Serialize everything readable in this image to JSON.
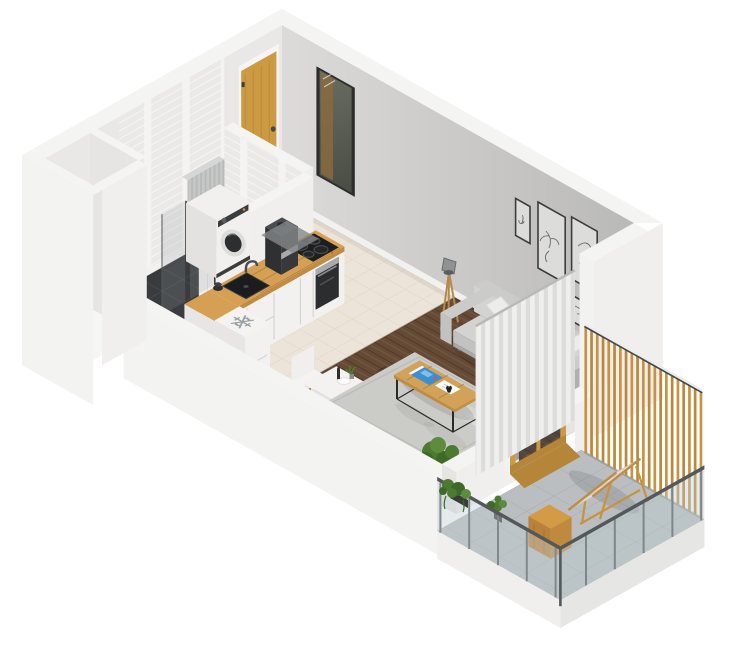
{
  "scene": {
    "type": "isometric-floorplan-render",
    "description": "3D isometric cutaway render of a studio apartment: bathroom with washing machine, entry hall with wooden door and mirror, L-shaped kitchen with cooktop, oven, coffee machine, sink and under-counter fridge, living-dining area with sofa, rug, coffee table, dining table, floor lamp and wall art, and a balcony with glass railing, wooden slat screen, lounger and plants.",
    "width_px": 750,
    "height_px": 668
  },
  "icons": {
    "snowflake": {
      "name": "snowflake-icon",
      "glyph": "❄"
    }
  },
  "rooms": [
    {
      "id": "bathroom",
      "label": "Bathroom"
    },
    {
      "id": "entry",
      "label": "Entry hall"
    },
    {
      "id": "kitchen",
      "label": "Kitchen"
    },
    {
      "id": "living-dining",
      "label": "Living / dining room"
    },
    {
      "id": "balcony",
      "label": "Balcony"
    }
  ],
  "objects": [
    "entry-door",
    "wall-mirror",
    "washing-machine",
    "shower-glass",
    "kitchen-counter",
    "cooktop",
    "oven",
    "coffee-machine",
    "kitchen-sink",
    "under-counter-fridge",
    "dining-table",
    "dining-chairs",
    "floor-plant",
    "sofa",
    "throw-pillows",
    "area-rug",
    "coffee-table",
    "magazine",
    "floor-lamp",
    "picture-frames",
    "curtains",
    "balcony-door",
    "balcony-lounger",
    "balcony-crate",
    "glass-railing",
    "wood-slat-screen",
    "hanging-plant"
  ],
  "colors": {
    "bg": "#ffffff",
    "wall_top": "#f4f4f2",
    "wall_white": "#f0efed",
    "wall_ext": "#f3f3f1",
    "wall_face": "#e9e8e6",
    "wall_inner": "#e6e5e3",
    "baseboard": "#f1f1ef",
    "wall_gray_light": "#dcdbd9",
    "wall_gray": "#cecdcb",
    "wall_gray_dark": "#b7b7b5",
    "brick": "#eae9e7",
    "brick_line": "#f7f6f4",
    "bath_tile": "#393b3e",
    "bath_grout": "#4d4f52",
    "tile": "#ece4d8",
    "tile_grout": "#dcd3c6",
    "wood": "#654b36",
    "wood_line": "#50392a",
    "counter_wood": "#d6a054",
    "counter_edge": "#c08c43",
    "cabinet": "#f2f1ef",
    "cabinet_shade": "#e7e6e4",
    "seam": "#d8d5d1",
    "appliance_dark": "#2c2d2f",
    "appliance_panel": "#1d1e20",
    "steel": "#a8aaac",
    "coffee_body": "#36383b",
    "coffee_top": "#4a4c4f",
    "sink": "#1b1c1e",
    "machine_white": "#f1f0ee",
    "machine_side": "#e3e2e0",
    "machine_dark": "#3a3c3e",
    "drum": "#2c2e30",
    "door_wood": "#cd9a44",
    "door_wood_dark": "#b5853a",
    "frame_white": "#f6f5f3",
    "hinge": "#3c3c3a",
    "mirror_frame": "#2c2d2f",
    "mirror_glass": "#585b55",
    "mirror_reflection": "#8a6a3e",
    "pic_frame": "#3c3c3a",
    "pic_paper": "#dcdcda",
    "art_line": "#6b6b69",
    "sofa": "#cbcbc9",
    "sofa_light": "#d3d3d1",
    "sofa_mid": "#c2c2c0",
    "sofa_dark": "#b0b0ae",
    "pillow_white": "#ececea",
    "pillow_gray": "#8e8f8d",
    "rug": "#cbcbc7",
    "rug_dark": "#bdbdb9",
    "table_top": "#d2a258",
    "table_frame": "#2a2a28",
    "magazine_blue": "#3e8ed2",
    "paper": "#fafaf8",
    "accent_red": "#e05540",
    "lamp_wood": "#b5894a",
    "lamp_head": "#8f9193",
    "curtain": "#efefed",
    "curtain_fold": "#dcdcda",
    "white_table": "#f3f2f0",
    "chair": "#f0efee",
    "balcony_tile": "#babec0",
    "balcony_grout": "#a7abad",
    "railing": "#53585b",
    "glass": "rgba(190,204,210,0.40)",
    "glass_dark": "rgba(55,65,70,0.45)",
    "slat": "#c8923e",
    "slat_dark": "#bb873a",
    "lounger": "#e0e0de",
    "plant": "#4c7a32",
    "plant_dark": "#3e6a28",
    "plant_light": "#5d8c3e",
    "pot": "#3a3c38",
    "fridge": "#f4f3f1",
    "snowflake": "#9aa0a3",
    "mat": "#85888a",
    "bottle": "#2e2e2c"
  }
}
